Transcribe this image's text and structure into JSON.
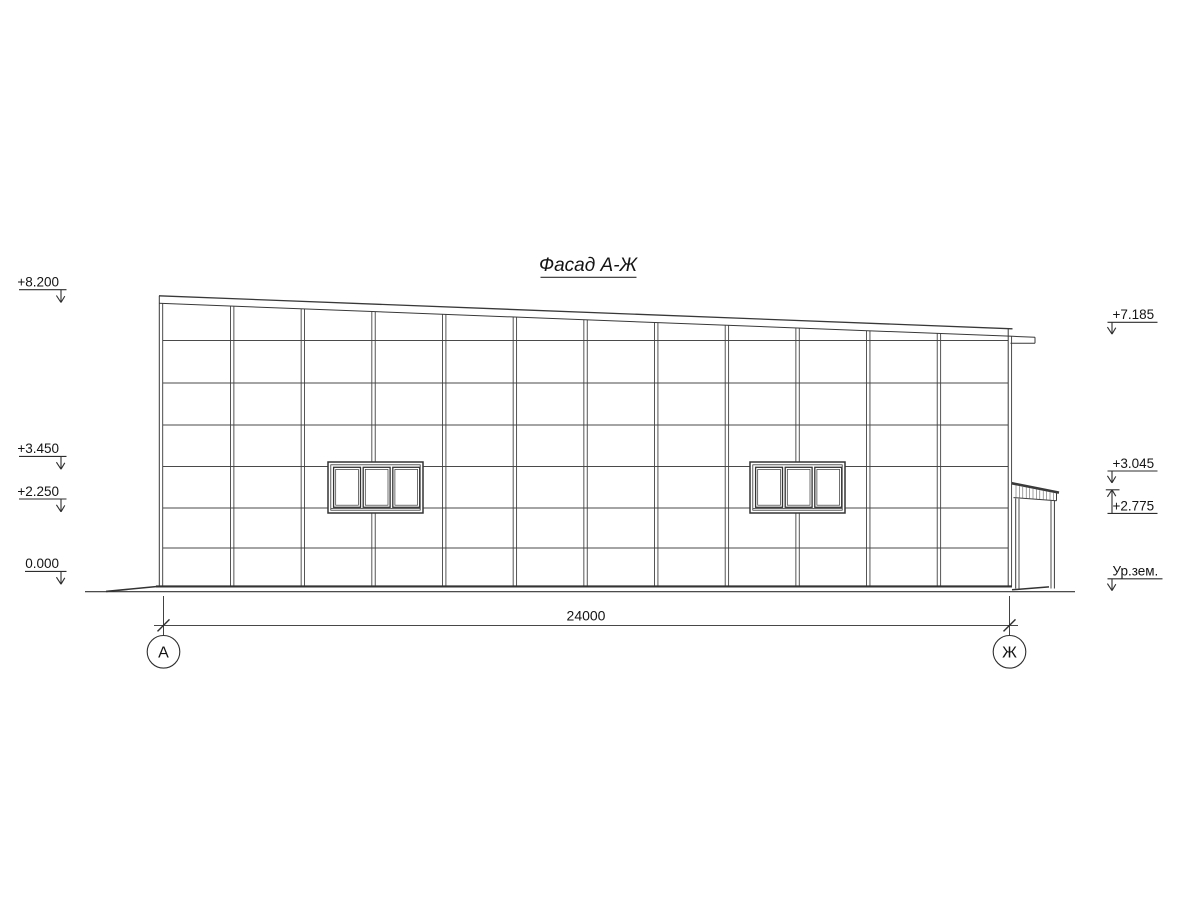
{
  "drawing": {
    "title": "Фасад А-Ж",
    "marks_left": [
      "+8.200",
      "+3.450",
      "+2.250",
      "0.000"
    ],
    "marks_right": [
      "+7.185",
      "+3.045",
      "+2.775",
      "Ур.зем."
    ],
    "dimension_total": "24000",
    "axes": [
      "А",
      "Ж"
    ],
    "colors": {
      "line": "#3f3f3f",
      "thick_line": "#2e2e2e",
      "text": "#141414",
      "background": "#ffffff"
    }
  }
}
